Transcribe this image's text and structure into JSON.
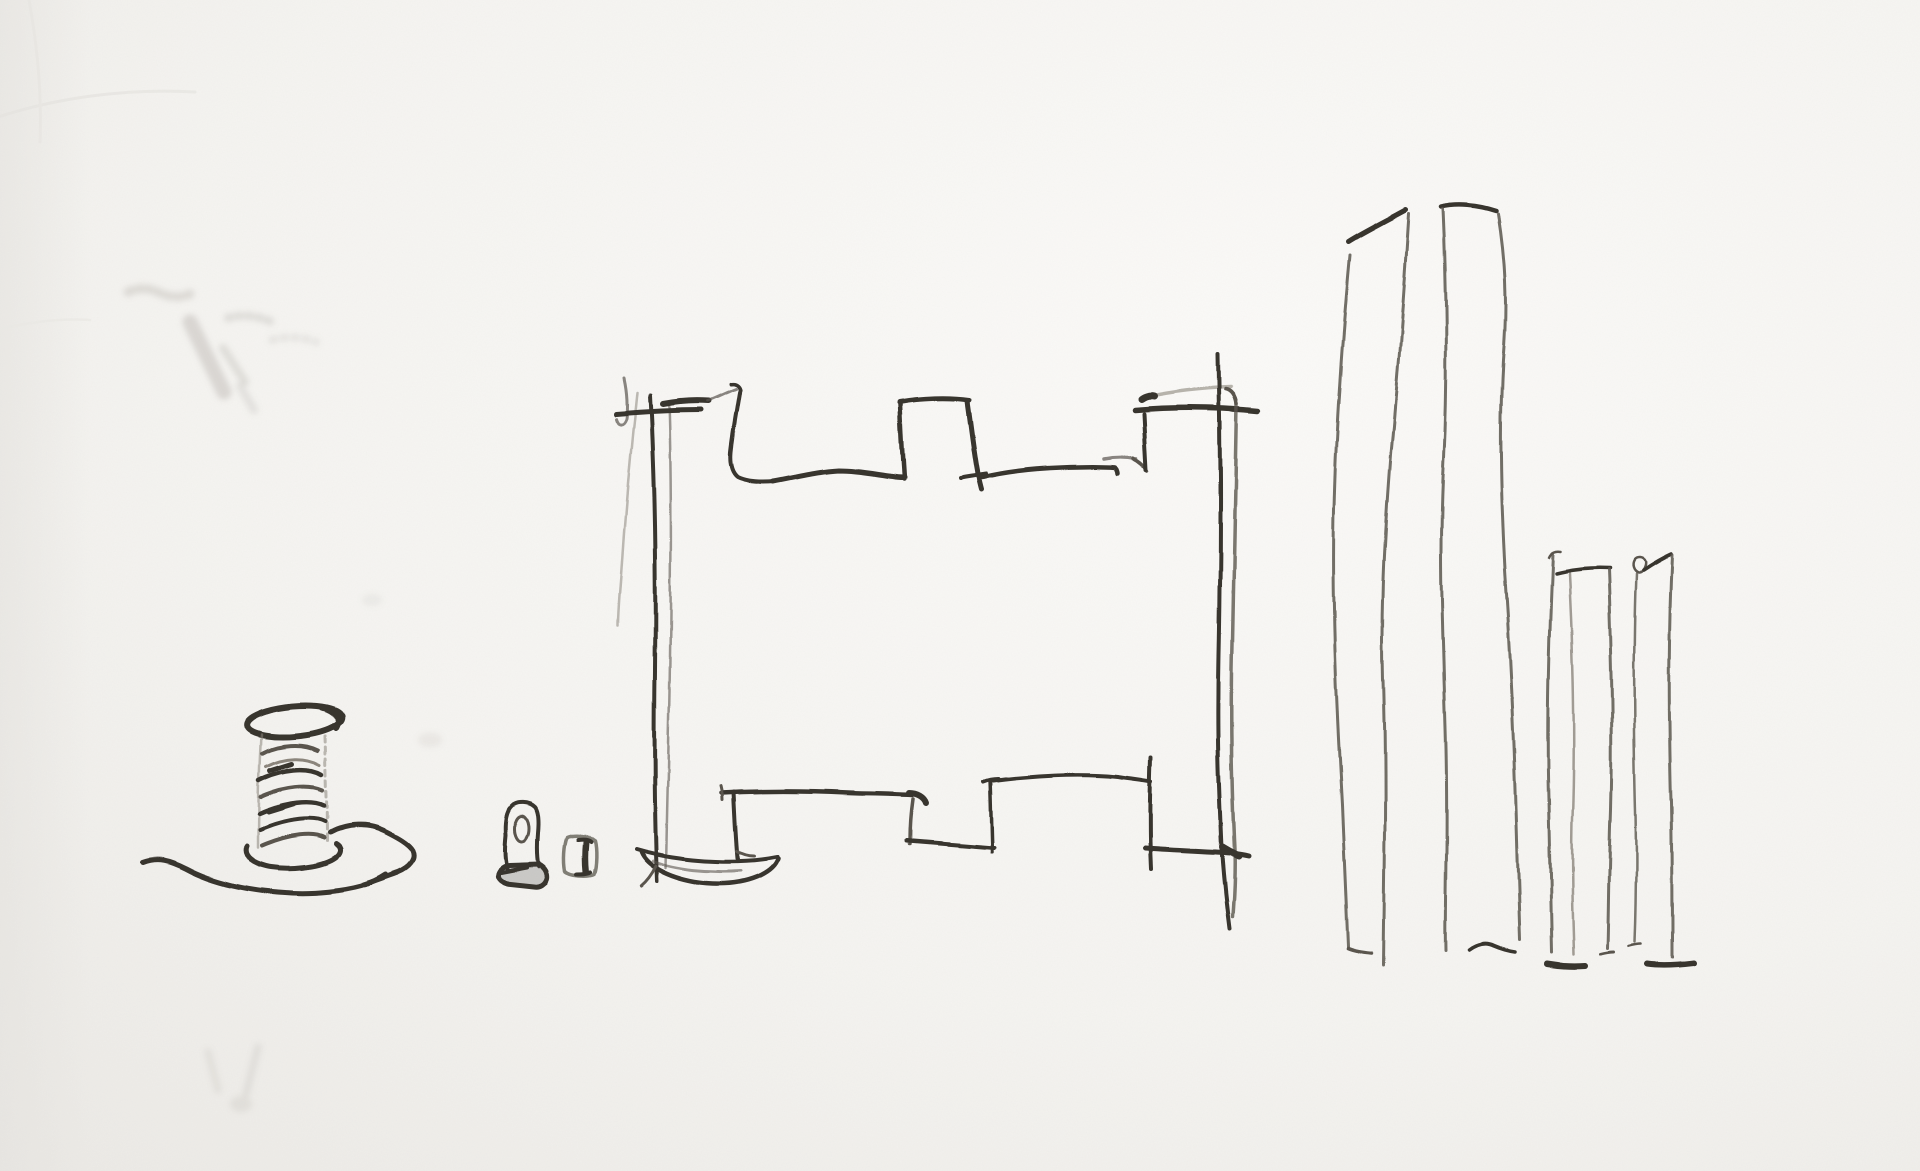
{
  "page": {
    "title": "Pencil sketch on white paper"
  },
  "artwork": {
    "medium": "pencil-sketch",
    "description": "Hand-drawn pencil sketch on white textured paper: a spool of thread resting on an open hand, a small rubber stamp beside a tiny box, the outline of a crenellated castle wall with a stepped base, two very tall narrow towers, and two shorter narrow towers.",
    "elements": [
      {
        "id": "thread-spool-on-hand",
        "label": "Spool of thread on an open hand"
      },
      {
        "id": "rubber-stamp",
        "label": "Small rubber stamp"
      },
      {
        "id": "small-box",
        "label": "Tiny box"
      },
      {
        "id": "castle-wall",
        "label": "Crenellated castle wall outline with stepped base and dish-shaped footing"
      },
      {
        "id": "twin-towers",
        "label": "Two tall narrow towers"
      },
      {
        "id": "small-towers",
        "label": "Two shorter narrow towers"
      }
    ],
    "palette": {
      "paper": "#f5f4f1",
      "paper_bright": "#fbfaf8",
      "paper_edge": "#eceae6",
      "graphite_dark": "#38342f",
      "graphite_mid": "#5a554e",
      "graphite_light": "#8b857c",
      "smudge": "#a19d95"
    }
  }
}
